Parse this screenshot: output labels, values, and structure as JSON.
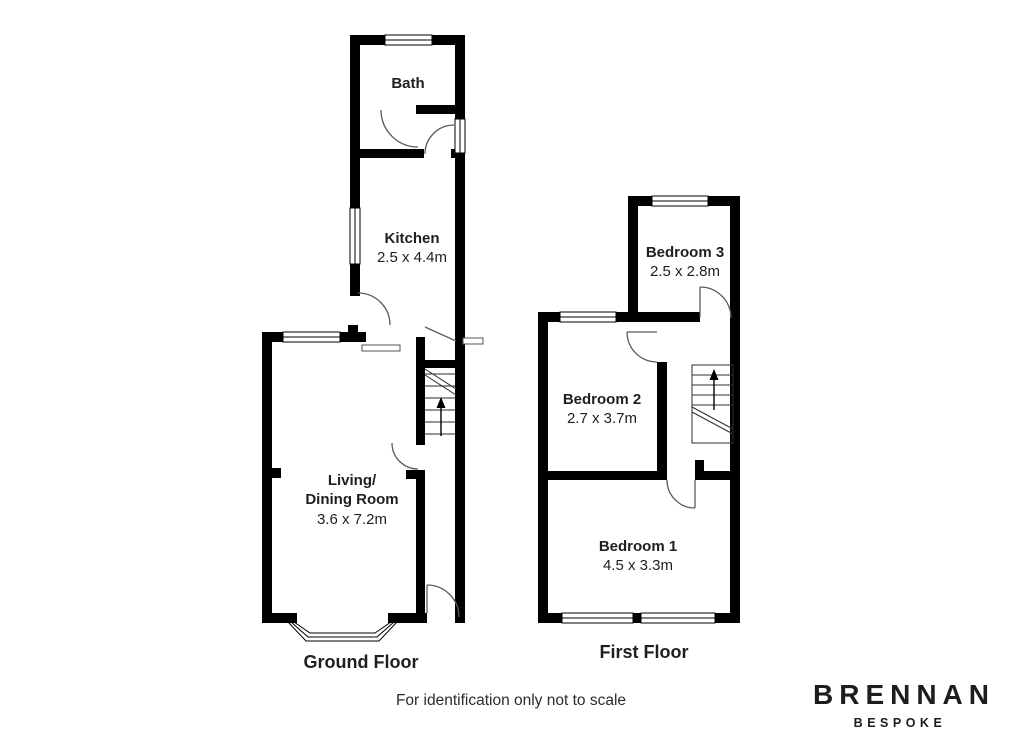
{
  "floorplan": {
    "ground_floor": {
      "label": "Ground Floor",
      "rooms": {
        "bath": {
          "name": "Bath"
        },
        "kitchen": {
          "name": "Kitchen",
          "size": "2.5 x 4.4m"
        },
        "living_dining": {
          "name_line1": "Living/",
          "name_line2": "Dining Room",
          "size": "3.6 x 7.2m"
        }
      }
    },
    "first_floor": {
      "label": "First Floor",
      "rooms": {
        "bedroom3": {
          "name": "Bedroom 3",
          "size": "2.5 x 2.8m"
        },
        "bedroom2": {
          "name": "Bedroom 2",
          "size": "2.7 x 3.7m"
        },
        "bedroom1": {
          "name": "Bedroom 1",
          "size": "4.5 x 3.3m"
        }
      }
    },
    "disclaimer": "For identification only not to scale",
    "colors": {
      "walls": "#000000",
      "labels": "#1f1f1f",
      "background": "#ffffff"
    }
  },
  "brand": {
    "name": "BRENNAN",
    "tagline": "BESPOKE",
    "color": "#1d1d1b"
  }
}
